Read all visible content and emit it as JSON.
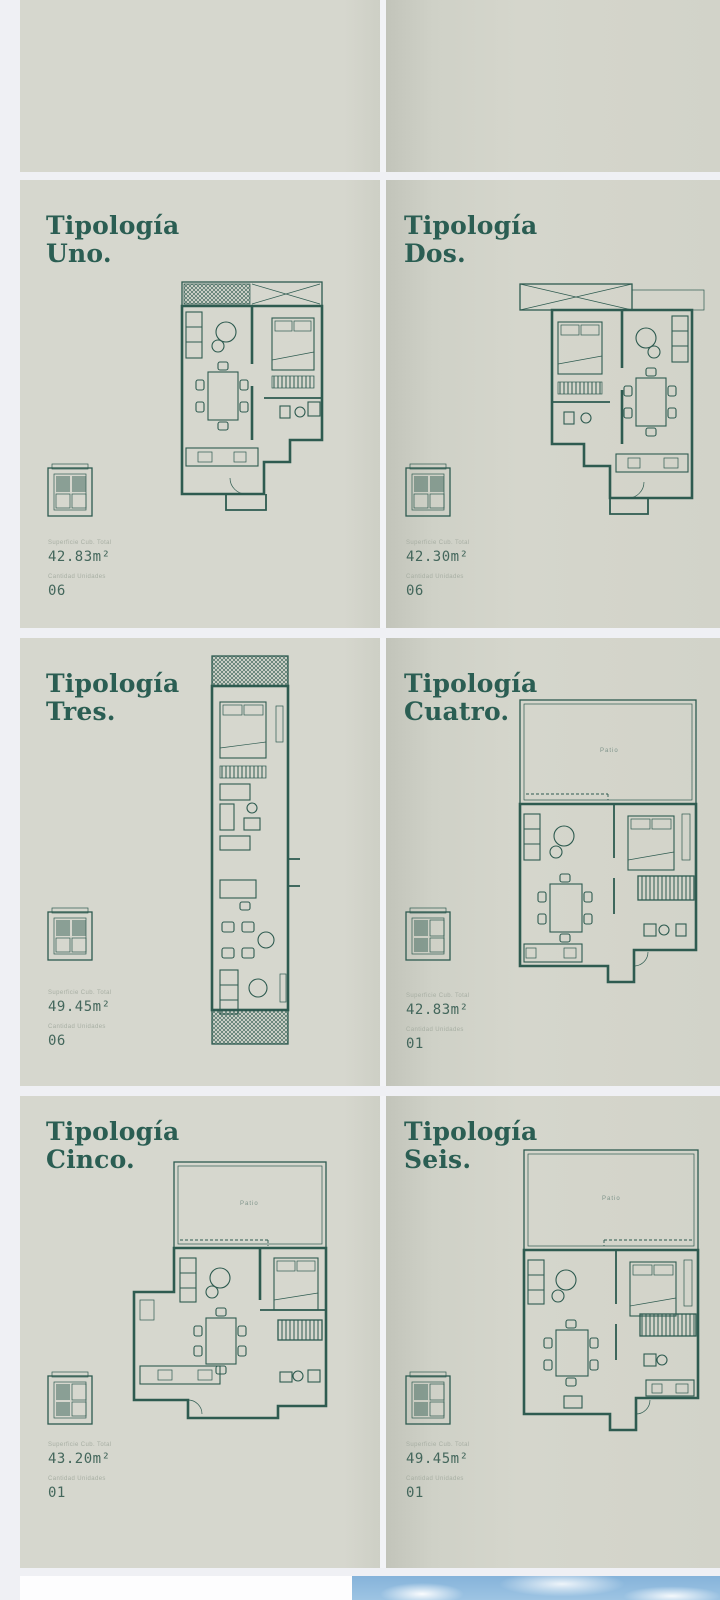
{
  "viewer": {
    "background_color": "#eff0f4",
    "page_color": "#d6d6cd",
    "accent_color": "#2b5e53",
    "line_color": "#2e5b50"
  },
  "brochure": {
    "panels": [
      {
        "id": "uno",
        "title_line1": "Tipología",
        "title_line2": "Uno.",
        "area_label": "Superficie Cub. Total",
        "area_value": "42.83m²",
        "units_label": "Cantidad Unidades",
        "units_value": "06"
      },
      {
        "id": "dos",
        "title_line1": "Tipología",
        "title_line2": "Dos.",
        "area_label": "Superficie Cub. Total",
        "area_value": "42.30m²",
        "units_label": "Cantidad Unidades",
        "units_value": "06"
      },
      {
        "id": "tres",
        "title_line1": "Tipología",
        "title_line2": "Tres.",
        "area_label": "Superficie Cub. Total",
        "area_value": "49.45m²",
        "units_label": "Cantidad Unidades",
        "units_value": "06"
      },
      {
        "id": "cuatro",
        "title_line1": "Tipología",
        "title_line2": "Cuatro.",
        "area_label": "Superficie Cub. Total",
        "area_value": "42.83m²",
        "units_label": "Cantidad Unidades",
        "units_value": "01",
        "patio_label": "Patio"
      },
      {
        "id": "cinco",
        "title_line1": "Tipología",
        "title_line2": "Cinco.",
        "area_label": "Superficie Cub. Total",
        "area_value": "43.20m²",
        "units_label": "Cantidad Unidades",
        "units_value": "01",
        "patio_label": "Patio"
      },
      {
        "id": "seis",
        "title_line1": "Tipología",
        "title_line2": "Seis.",
        "area_label": "Superficie Cub. Total",
        "area_value": "49.45m²",
        "units_label": "Cantidad Unidades",
        "units_value": "01",
        "patio_label": "Patio"
      }
    ]
  }
}
